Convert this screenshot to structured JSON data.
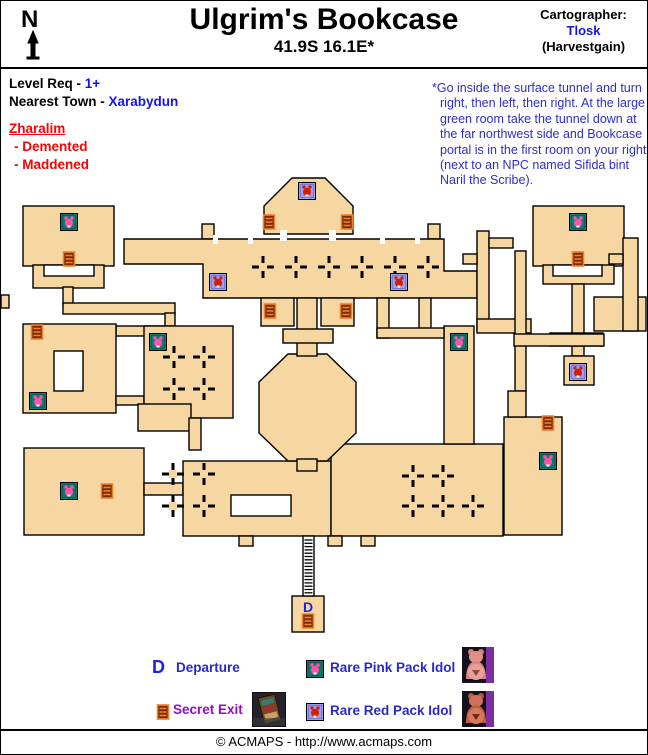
{
  "header": {
    "title": "Ulgrim's Bookcase",
    "coordinates": "41.9S 16.1E*",
    "cartographer_label": "Cartographer:",
    "cartographer_name": "Tlosk",
    "cartographer_server": "(Harvestgain)",
    "compass_letter": "N"
  },
  "info": {
    "level_req_label": "Level Req - ",
    "level_req_value": "1+",
    "town_label": "Nearest Town - ",
    "town_value": "Xarabydun",
    "faction": "Zharalim",
    "mobs": [
      "- Demented",
      "- Maddened"
    ]
  },
  "note": {
    "asterisk": "*",
    "text": "Go inside the surface tunnel and turn right, then left, then right. At the large green room take the tunnel down at the far northwest side and Bookcase portal is in the first room on your right (next to an NPC named Sifida bint Naril the Scribe)."
  },
  "map": {
    "departure_letter": "D",
    "icons": [
      {
        "type": "red_idol",
        "x": 306,
        "y": 190
      },
      {
        "type": "pink_idol",
        "x": 68,
        "y": 221
      },
      {
        "type": "pink_idol",
        "x": 577,
        "y": 221
      },
      {
        "type": "secret_exit",
        "x": 268,
        "y": 221
      },
      {
        "type": "secret_exit",
        "x": 346,
        "y": 221
      },
      {
        "type": "secret_exit",
        "x": 68,
        "y": 258
      },
      {
        "type": "secret_exit",
        "x": 577,
        "y": 258
      },
      {
        "type": "red_idol",
        "x": 217,
        "y": 281
      },
      {
        "type": "red_idol",
        "x": 398,
        "y": 281
      },
      {
        "type": "secret_exit",
        "x": 269,
        "y": 310
      },
      {
        "type": "secret_exit",
        "x": 345,
        "y": 310
      },
      {
        "type": "secret_exit",
        "x": 36,
        "y": 331
      },
      {
        "type": "pink_idol",
        "x": 157,
        "y": 341
      },
      {
        "type": "pink_idol",
        "x": 458,
        "y": 341
      },
      {
        "type": "red_idol",
        "x": 577,
        "y": 371
      },
      {
        "type": "pink_idol",
        "x": 37,
        "y": 400
      },
      {
        "type": "secret_exit",
        "x": 547,
        "y": 422
      },
      {
        "type": "pink_idol",
        "x": 547,
        "y": 460
      },
      {
        "type": "pink_idol",
        "x": 68,
        "y": 490
      },
      {
        "type": "secret_exit",
        "x": 106,
        "y": 490
      },
      {
        "type": "secret_exit",
        "x": 307,
        "y": 620
      }
    ]
  },
  "legend": {
    "departure_symbol": "D",
    "departure_label": "Departure",
    "secret_exit_label": "Secret Exit",
    "pink_idol_label": "Rare Pink Pack Idol",
    "red_idol_label": "Rare Red Pack Idol"
  },
  "footer": {
    "copyright": "© ACMAPS - http://www.acmaps.com"
  },
  "colors": {
    "map_fill": "#F6D7A2",
    "wall": "#000000",
    "link_blue": "#1414E8",
    "note_blue": "#2E2EC8",
    "warn_red": "#FF0000",
    "secret_purple": "#9010C0",
    "pink_idol_bg": "#0E7A70",
    "pink_idol_fg": "#FF52A8",
    "red_idol_bg": "#9C9CF2",
    "red_idol_fg": "#D42000",
    "secret_fill": "#7A2E08",
    "secret_rung": "#F08030"
  }
}
